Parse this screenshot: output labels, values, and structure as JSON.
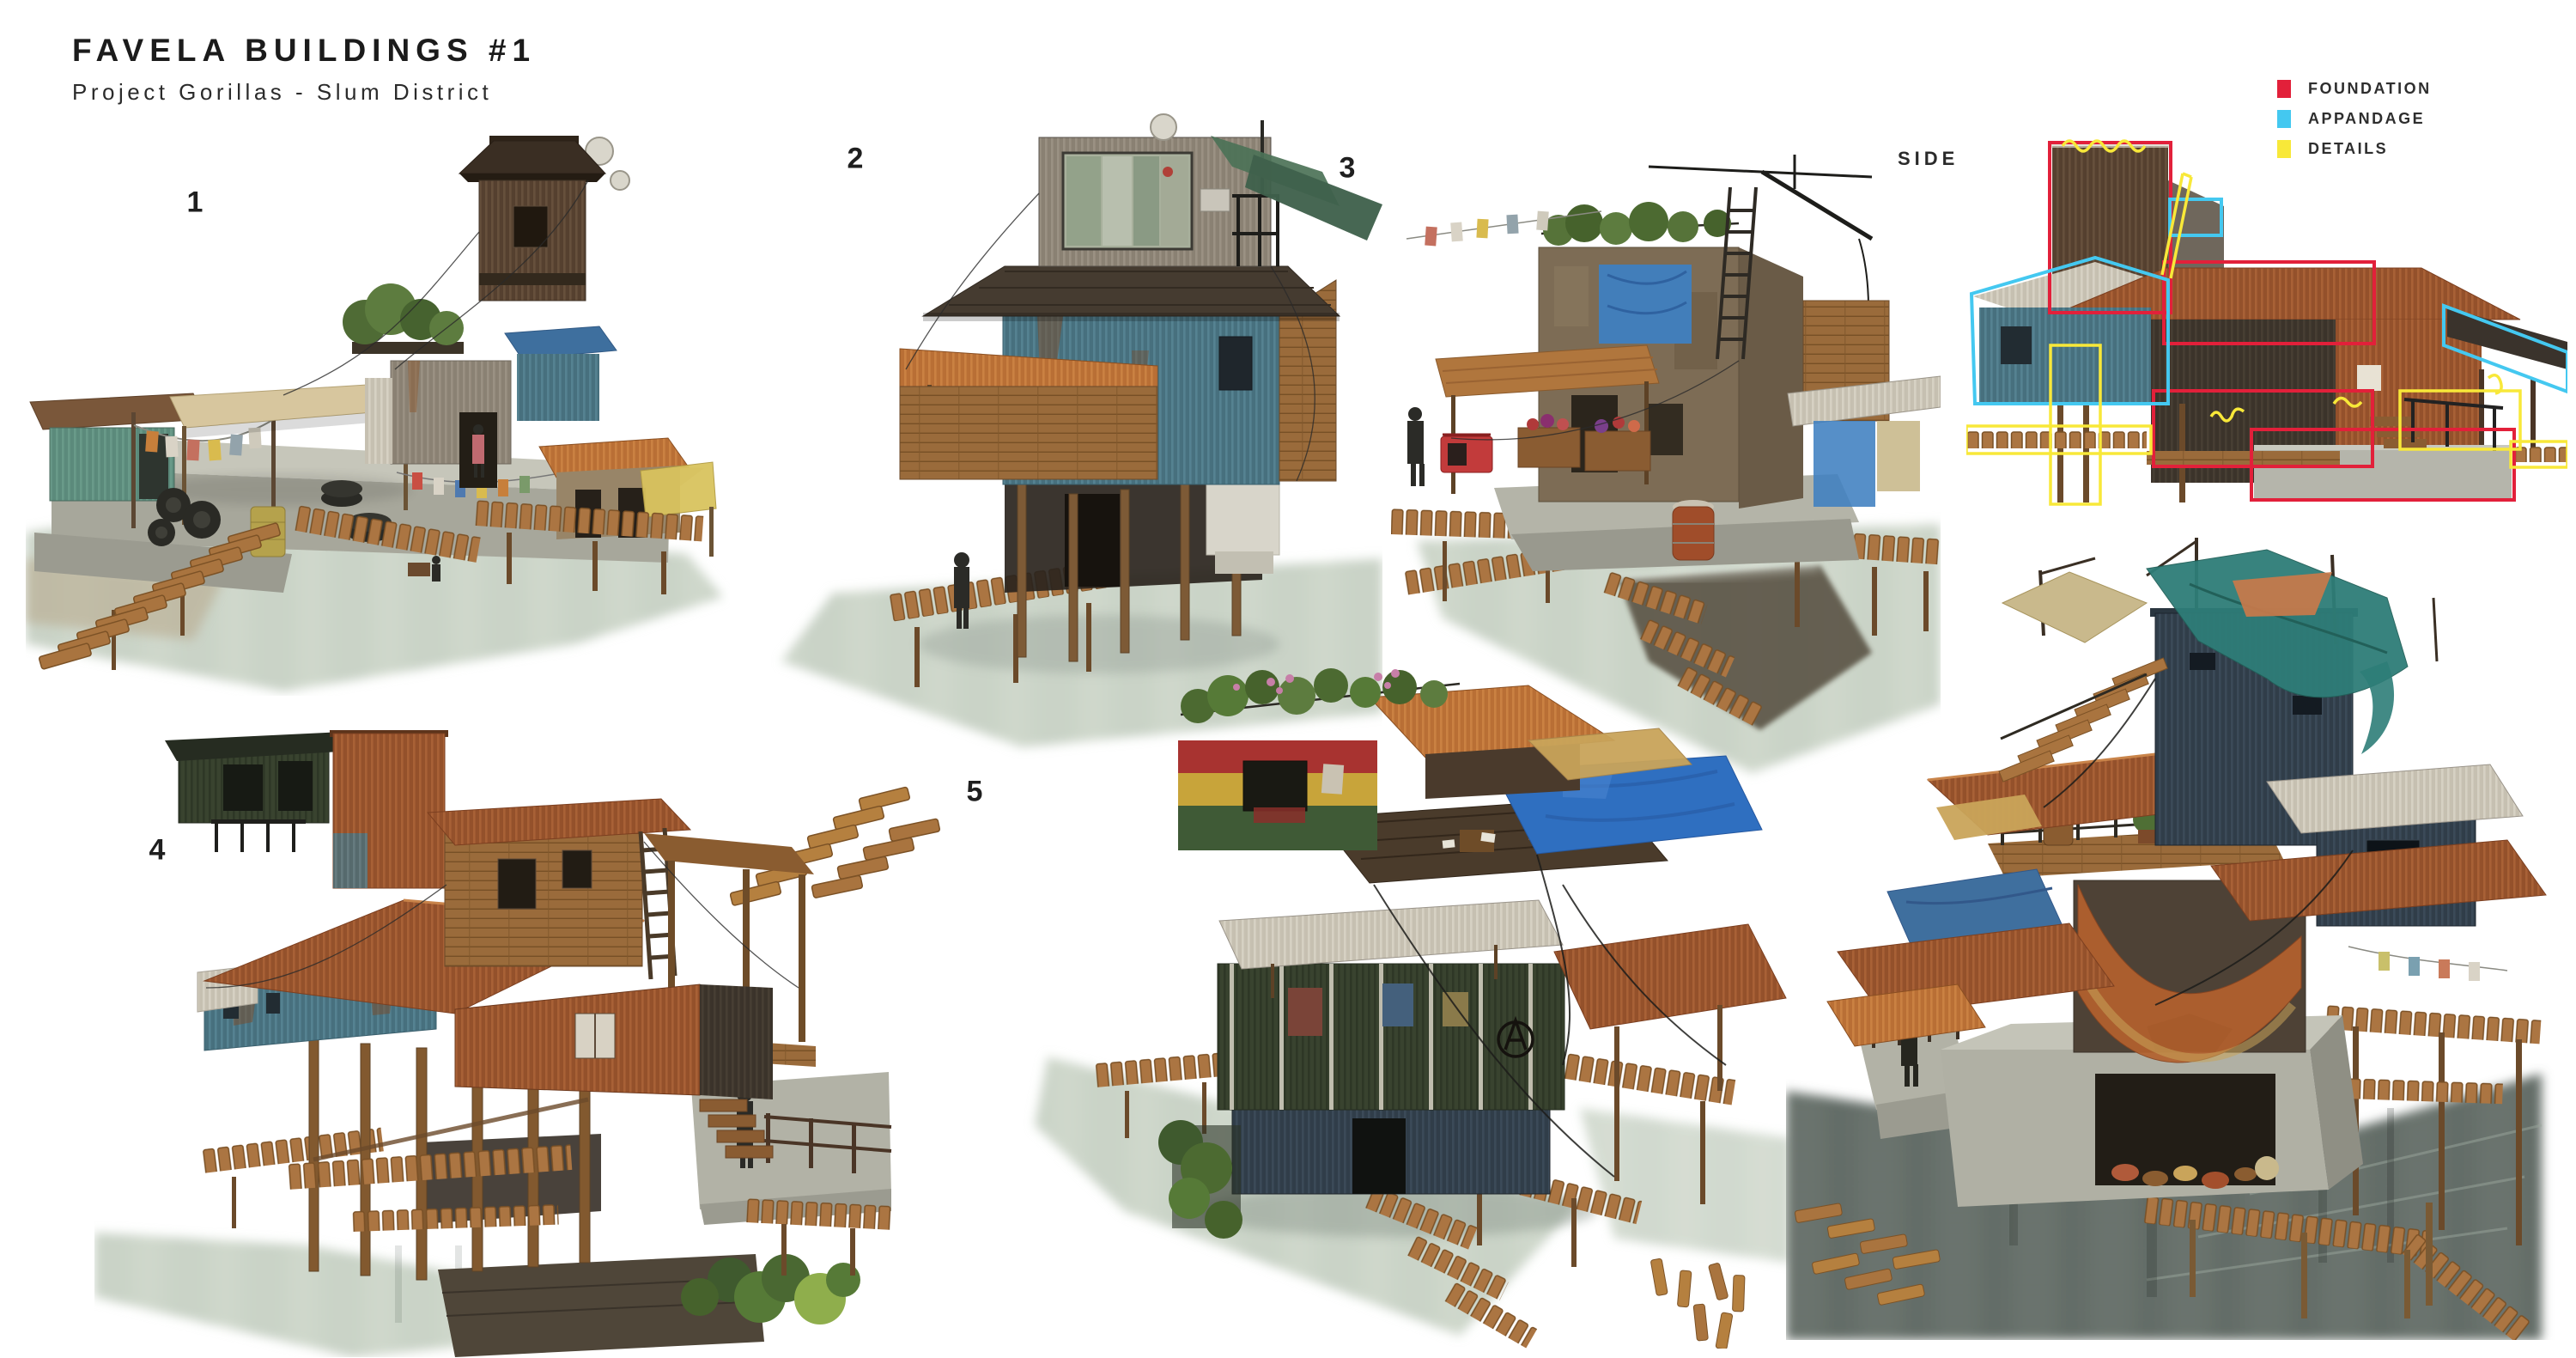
{
  "header": {
    "title": "FAVELA BUILDINGS #1",
    "subtitle": "Project Gorillas - Slum District"
  },
  "side_view": {
    "label": "SIDE"
  },
  "legend": {
    "items": [
      {
        "id": "foundation",
        "label": "FOUNDATION",
        "color": "#e2203a"
      },
      {
        "id": "appandage",
        "label": "APPANDAGE",
        "color": "#44c8f0"
      },
      {
        "id": "details",
        "label": "DETAILS",
        "color": "#f8e839"
      }
    ]
  },
  "figures": [
    {
      "number": "1"
    },
    {
      "number": "2"
    },
    {
      "number": "3"
    },
    {
      "number": "4"
    },
    {
      "number": "5"
    },
    {
      "number": "6"
    }
  ]
}
